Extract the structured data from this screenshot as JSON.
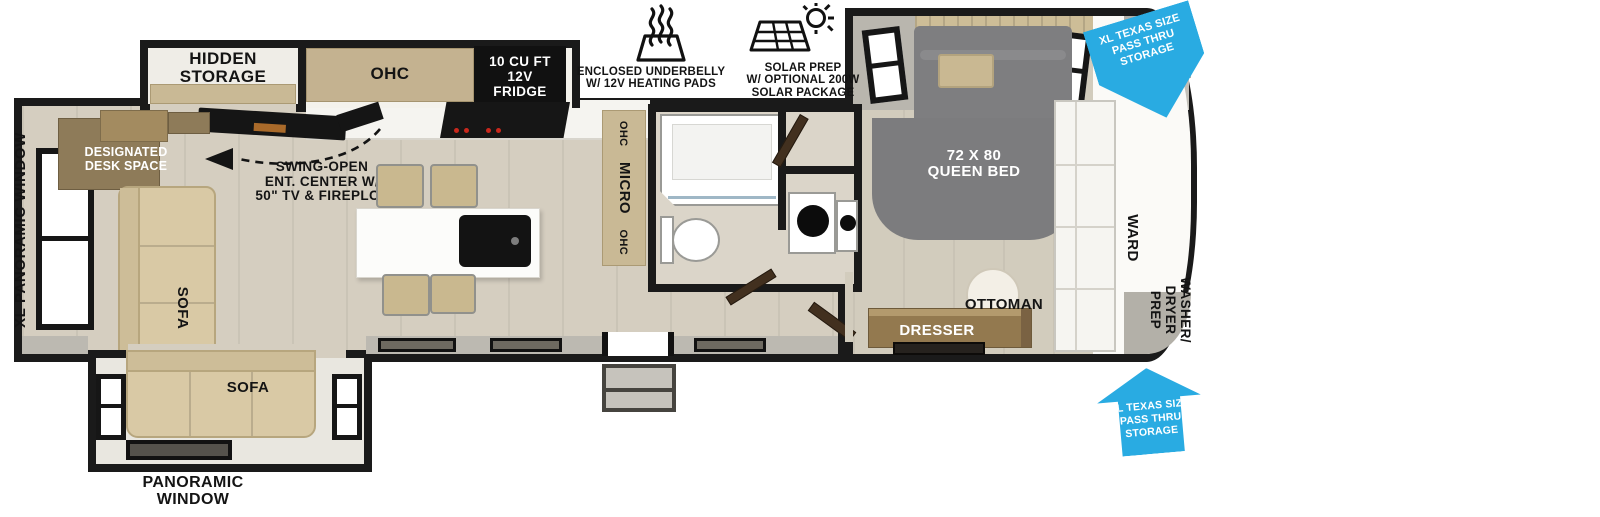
{
  "colors": {
    "wall": "#1a1a1a",
    "floor": "#d5cec0",
    "cabinet_tan": "#c9b995",
    "wood": "#8e7a57",
    "sofa_tan": "#d9c9a5",
    "bed_gray": "#7d7d7f",
    "arrow_blue": "#29abe2",
    "burner_red": "#c9281d"
  },
  "legend": {
    "underbelly": {
      "icon": "heating-pads-icon",
      "lines": [
        "ENCLOSED UNDERBELLY",
        "W/ 12V HEATING PADS"
      ]
    },
    "solar": {
      "icon": "solar-prep-icon",
      "lines": [
        "SOLAR PREP",
        "W/ OPTIONAL 200W",
        "SOLAR PACKAGE"
      ]
    }
  },
  "arrows": {
    "front_pass_thru": {
      "lines": [
        "XL TEXAS SIZE",
        "PASS THRU",
        "STORAGE"
      ]
    },
    "lower_pass_thru": {
      "lines": [
        "XL TEXAS SIZE",
        "PASS THRU",
        "STORAGE"
      ]
    }
  },
  "living": {
    "hidden_storage": [
      "HIDDEN",
      "STORAGE"
    ],
    "ohc": "OHC",
    "fridge": [
      "10 CU FT",
      "12V",
      "FRIDGE"
    ],
    "ent_center": [
      "SWING-OPEN",
      "ENT. CENTER W/",
      "50\" TV & FIREPLCE"
    ],
    "desk": [
      "DESIGNATED",
      "DESK SPACE"
    ],
    "rear_window": "XL PANORAMIC WINDOW",
    "sofa_side": "SOFA",
    "sofa_slide": "SOFA",
    "slide_window": [
      "PANORAMIC",
      "WINDOW"
    ],
    "galley_strip": [
      "OHC",
      "MICRO",
      "OHC"
    ]
  },
  "bedroom": {
    "bed": [
      "72 X 80",
      "QUEEN BED"
    ],
    "ward": "WARD",
    "washer_dryer_prep": [
      "WASHER/",
      "DRYER",
      "PREP"
    ],
    "dresser": "DRESSER",
    "ottoman": "OTTOMAN"
  }
}
